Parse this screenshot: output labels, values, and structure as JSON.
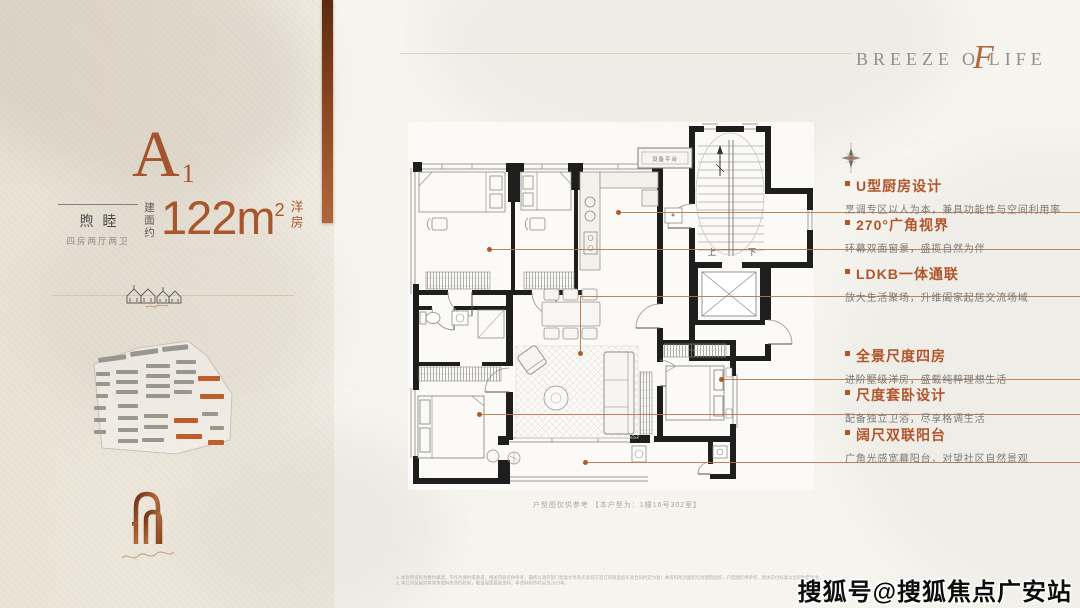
{
  "brand": {
    "prefix": "BREEZE",
    "o": "O",
    "script_f": "F",
    "suffix": "LIFE"
  },
  "unit": {
    "letter": "A",
    "number": "1",
    "name": "煦睦",
    "layout": "四房两厅两卫",
    "area_prefix": "建面约",
    "area_value": "122m",
    "area_sup": "2",
    "area_suffix": "洋房"
  },
  "features": [
    {
      "title": "U型厨房设计",
      "desc": "烹调专区以人为本，兼具功能性与空间利用率"
    },
    {
      "title": "270°广角视界",
      "desc": "环幕双面窗景，盛揽自然为伴"
    },
    {
      "title": "LDKB一体通联",
      "desc": "放大生活聚场，升维阖家起居交流场域"
    },
    {
      "title": "全景尺度四房",
      "desc": "进阶墅级洋房，盛载纯粹理想生活"
    },
    {
      "title": "尺度套卧设计",
      "desc": "配备独立卫浴，尽享格调生活"
    },
    {
      "title": "阔尺双联阳台",
      "desc": "广角光感宽幕阳台，对望社区自然景观"
    }
  ],
  "plan": {
    "equipment_label": "设备平台",
    "stairs_up": "上",
    "stairs_down": "下",
    "caption": "户型图仅供参考 【本户型为：1幢16号302室】"
  },
  "watermark": "搜狐号@搜狐焦点广安站",
  "disclaimer": {
    "line1": "1. 本宣传资料为要约邀请，不作为要约或承诺，相关内容仅供参考，最终以政府部门批准文件及买卖双方签订的商品房买卖合同约定为准；本资料所涉面积均为建筑面积，户型图仅供参考，具体交付标准以合同约定为准。",
    "line2": "2. 本公司保留对本宣传资料修改的权利，敬请留意最新资料；本资料制作时间为2023年。"
  },
  "colors": {
    "accent": "#a8562c",
    "accent_light": "#ba7648",
    "wall": "#1e1e1e"
  }
}
